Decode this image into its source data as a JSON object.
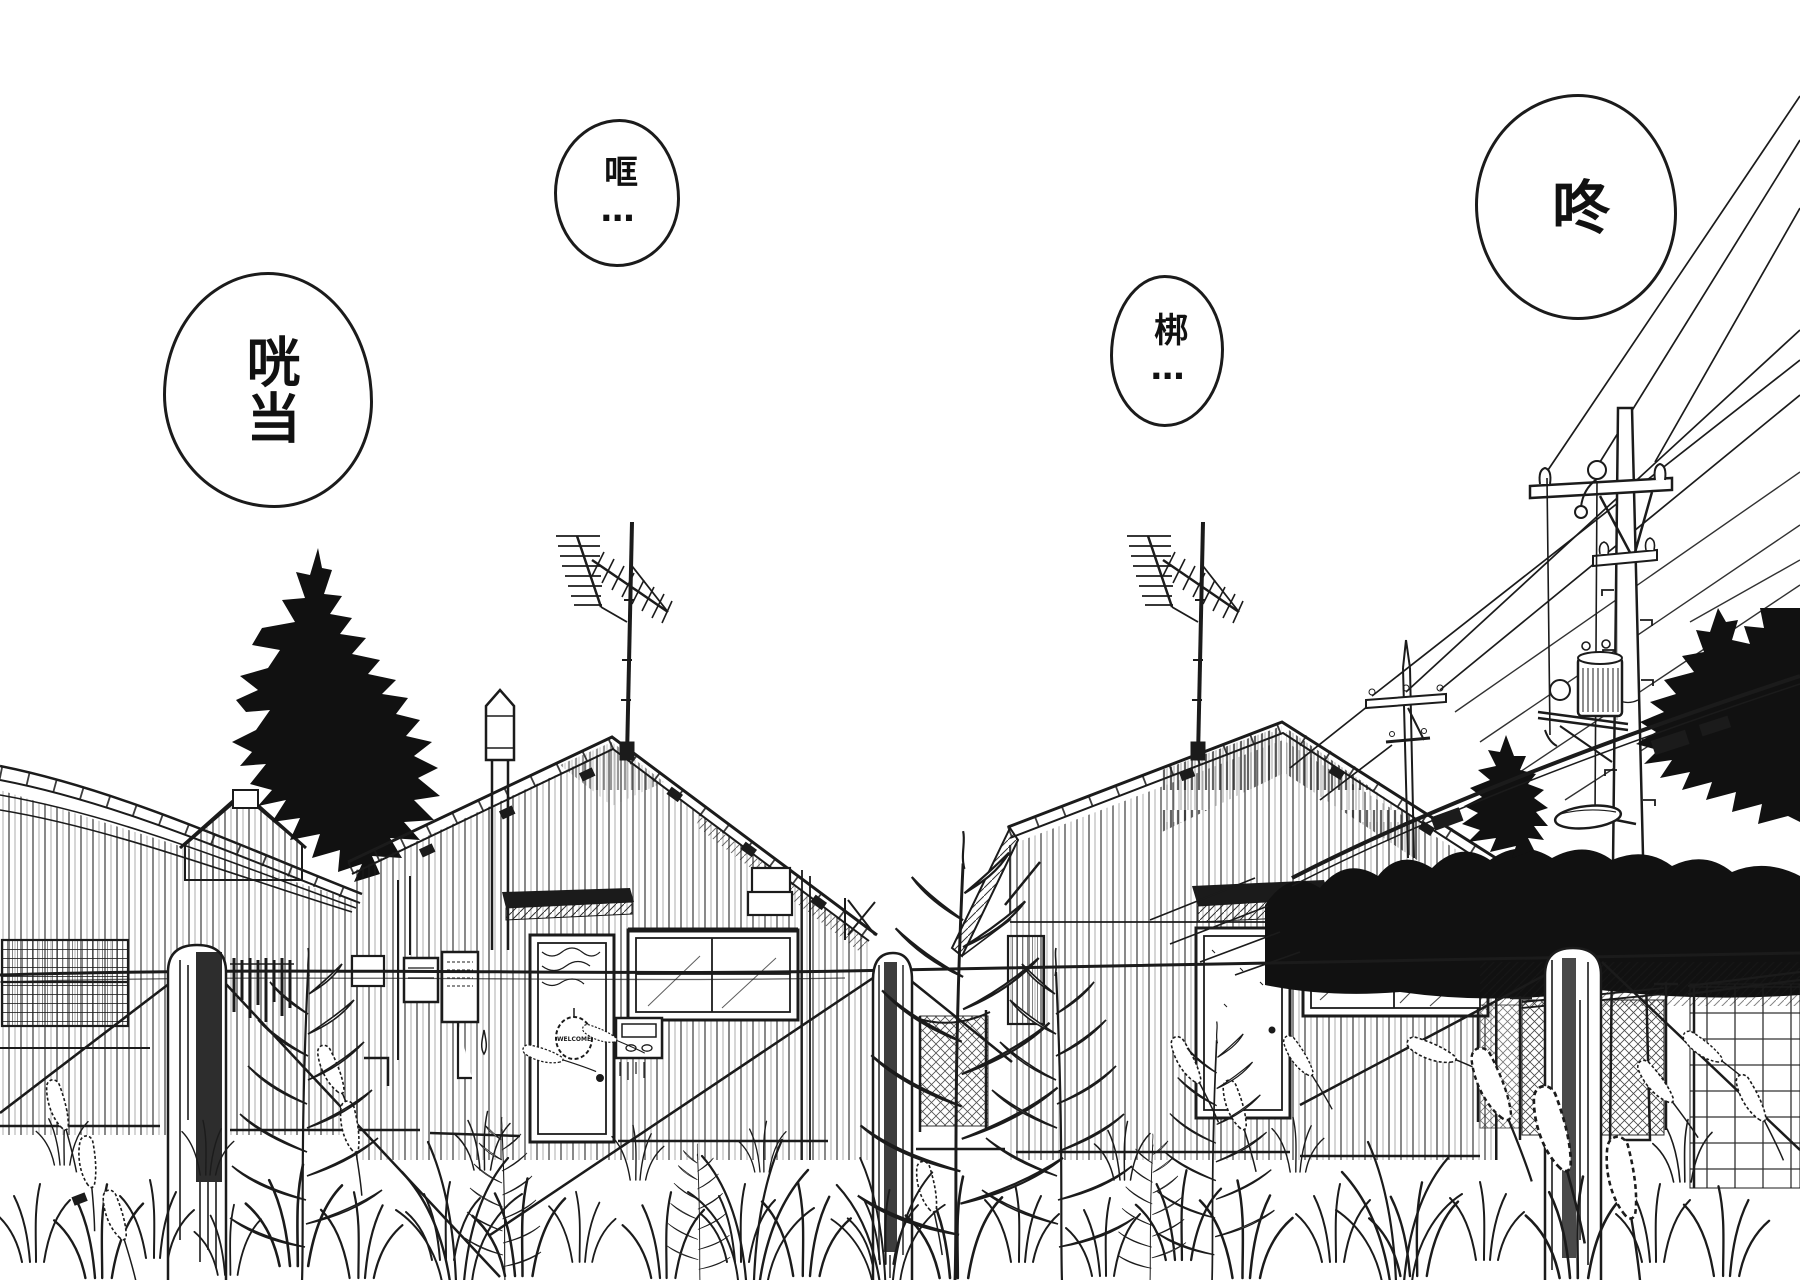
{
  "page": {
    "type": "manga-panel",
    "background_color": "#ffffff",
    "ink_color": "#1b1b1b"
  },
  "sfx_bubbles": [
    {
      "name": "sfx-clang",
      "text": "咣当"
    },
    {
      "name": "sfx-kuang",
      "text": "哐…"
    },
    {
      "name": "sfx-bang",
      "text": "梆…"
    },
    {
      "name": "sfx-dong",
      "text": "咚"
    }
  ],
  "signs": {
    "door_sign": "WELCOME"
  }
}
